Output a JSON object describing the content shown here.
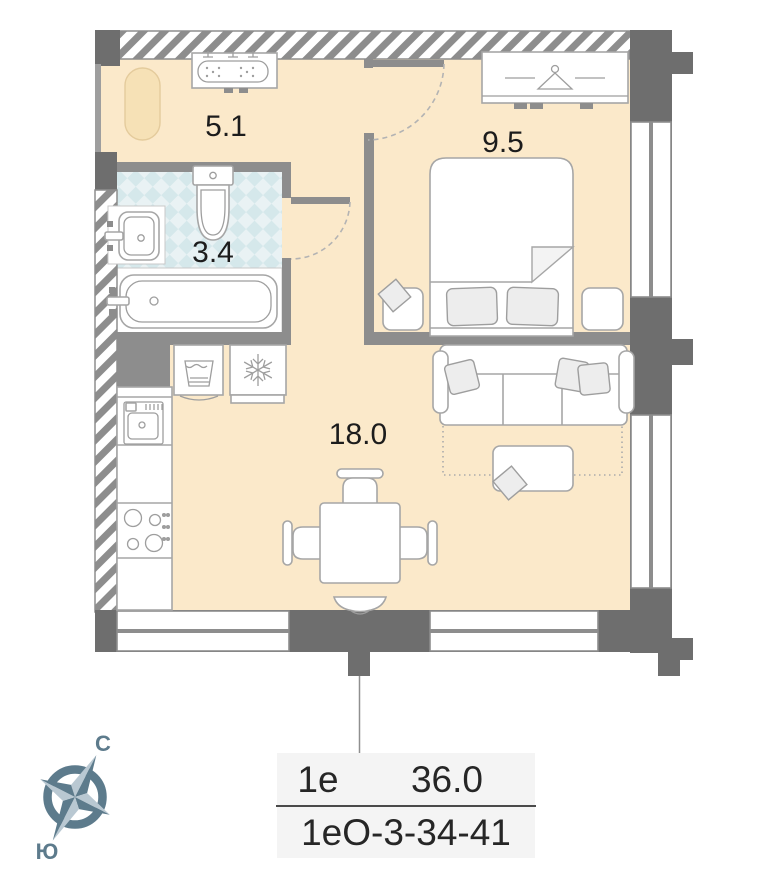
{
  "title": "apartment floor plan",
  "rooms": {
    "hallway": {
      "name": "hallway",
      "area": "5.1"
    },
    "bathroom": {
      "name": "bathroom",
      "area": "3.4"
    },
    "bedroom": {
      "name": "bedroom",
      "area": "9.5"
    },
    "living_kitchen": {
      "name": "living-kitchen",
      "area": "18.0"
    }
  },
  "compass": {
    "north_label": "С",
    "south_label": "Ю"
  },
  "info_table": {
    "flat_type": "1е",
    "total_area": "36.0",
    "flat_code": "1еО-3-34-41"
  },
  "colors": {
    "floor": "#fbe9ca",
    "tile": "#d5e8eb",
    "wall_dark": "#6e6e6e",
    "wall_light": "#8d8d8d",
    "compass": "#5d7b8c",
    "table_bg": "#f4f4f4"
  }
}
